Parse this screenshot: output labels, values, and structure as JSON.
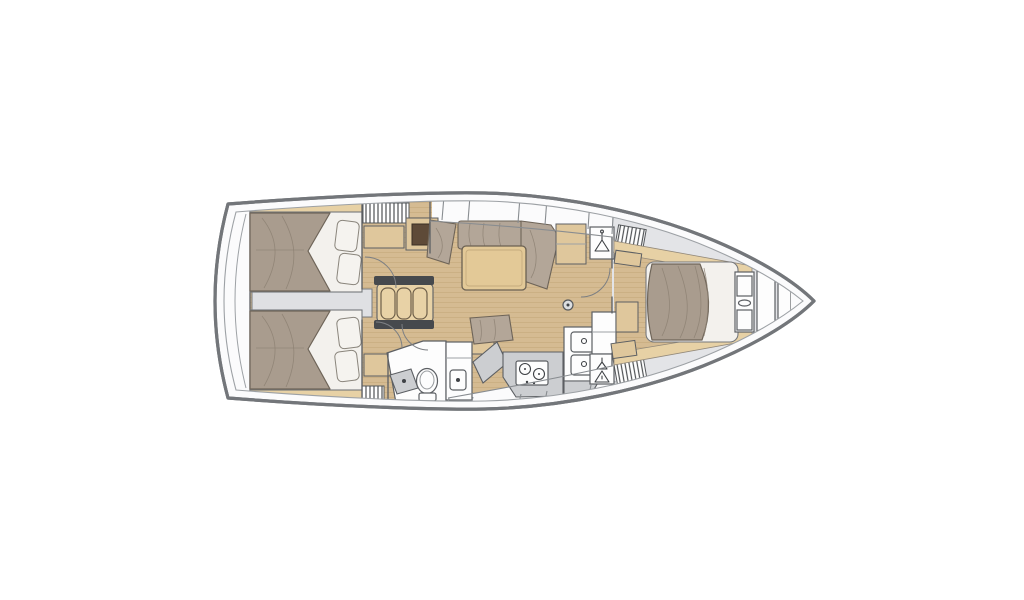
{
  "title": "Sailboat interior floor plan (top view, bow right)",
  "colors": {
    "hullStroke": "#73767a",
    "innerLine": "#9da1a5",
    "deckWhite": "#fbfbfc",
    "deckGray": "#e3e4e7",
    "floorTan": "#d5bb92",
    "plankLine": "#c0a173",
    "woodTrim": "#e7d1a5",
    "woodCab": "#dfc79c",
    "table": "#e3c997",
    "stepsWood": "#e8d2a6",
    "duvet": "#a99c8e",
    "cushion": "#b3a698",
    "crease": "#8d8173",
    "pillow": "#f5f3ef",
    "baseWhite": "#f3f1ed",
    "fixtureGray": "#ccced1",
    "engineGray": "#dfe0e3",
    "darkBar": "#46494d",
    "wall": "#5c5f63",
    "darkInset": "#5e4a38",
    "glyph": "#3f4246",
    "background": "#ffffff"
  },
  "rooms": [
    {
      "id": "aft-cabin-port",
      "label": "Aft double cabin (port)"
    },
    {
      "id": "aft-cabin-starboard",
      "label": "Aft double cabin (starboard)"
    },
    {
      "id": "salon",
      "label": "Salon with L-settee and table"
    },
    {
      "id": "galley",
      "label": "Galley with stove and double sink"
    },
    {
      "id": "head",
      "label": "Head with toilet and shower"
    },
    {
      "id": "nav-station",
      "label": "Nav seat and chart table"
    },
    {
      "id": "forward-cabin",
      "label": "Forward cabin with island berth"
    },
    {
      "id": "anchor-locker",
      "label": "Bow anchor locker"
    }
  ],
  "icons": [
    {
      "name": "hanger-icon",
      "meaning": "hanging locker"
    },
    {
      "name": "mast-post-icon",
      "meaning": "mast / compression post"
    },
    {
      "name": "burner-icon",
      "meaning": "stove burner"
    },
    {
      "name": "drain-icon",
      "meaning": "sink / shower drain"
    }
  ]
}
